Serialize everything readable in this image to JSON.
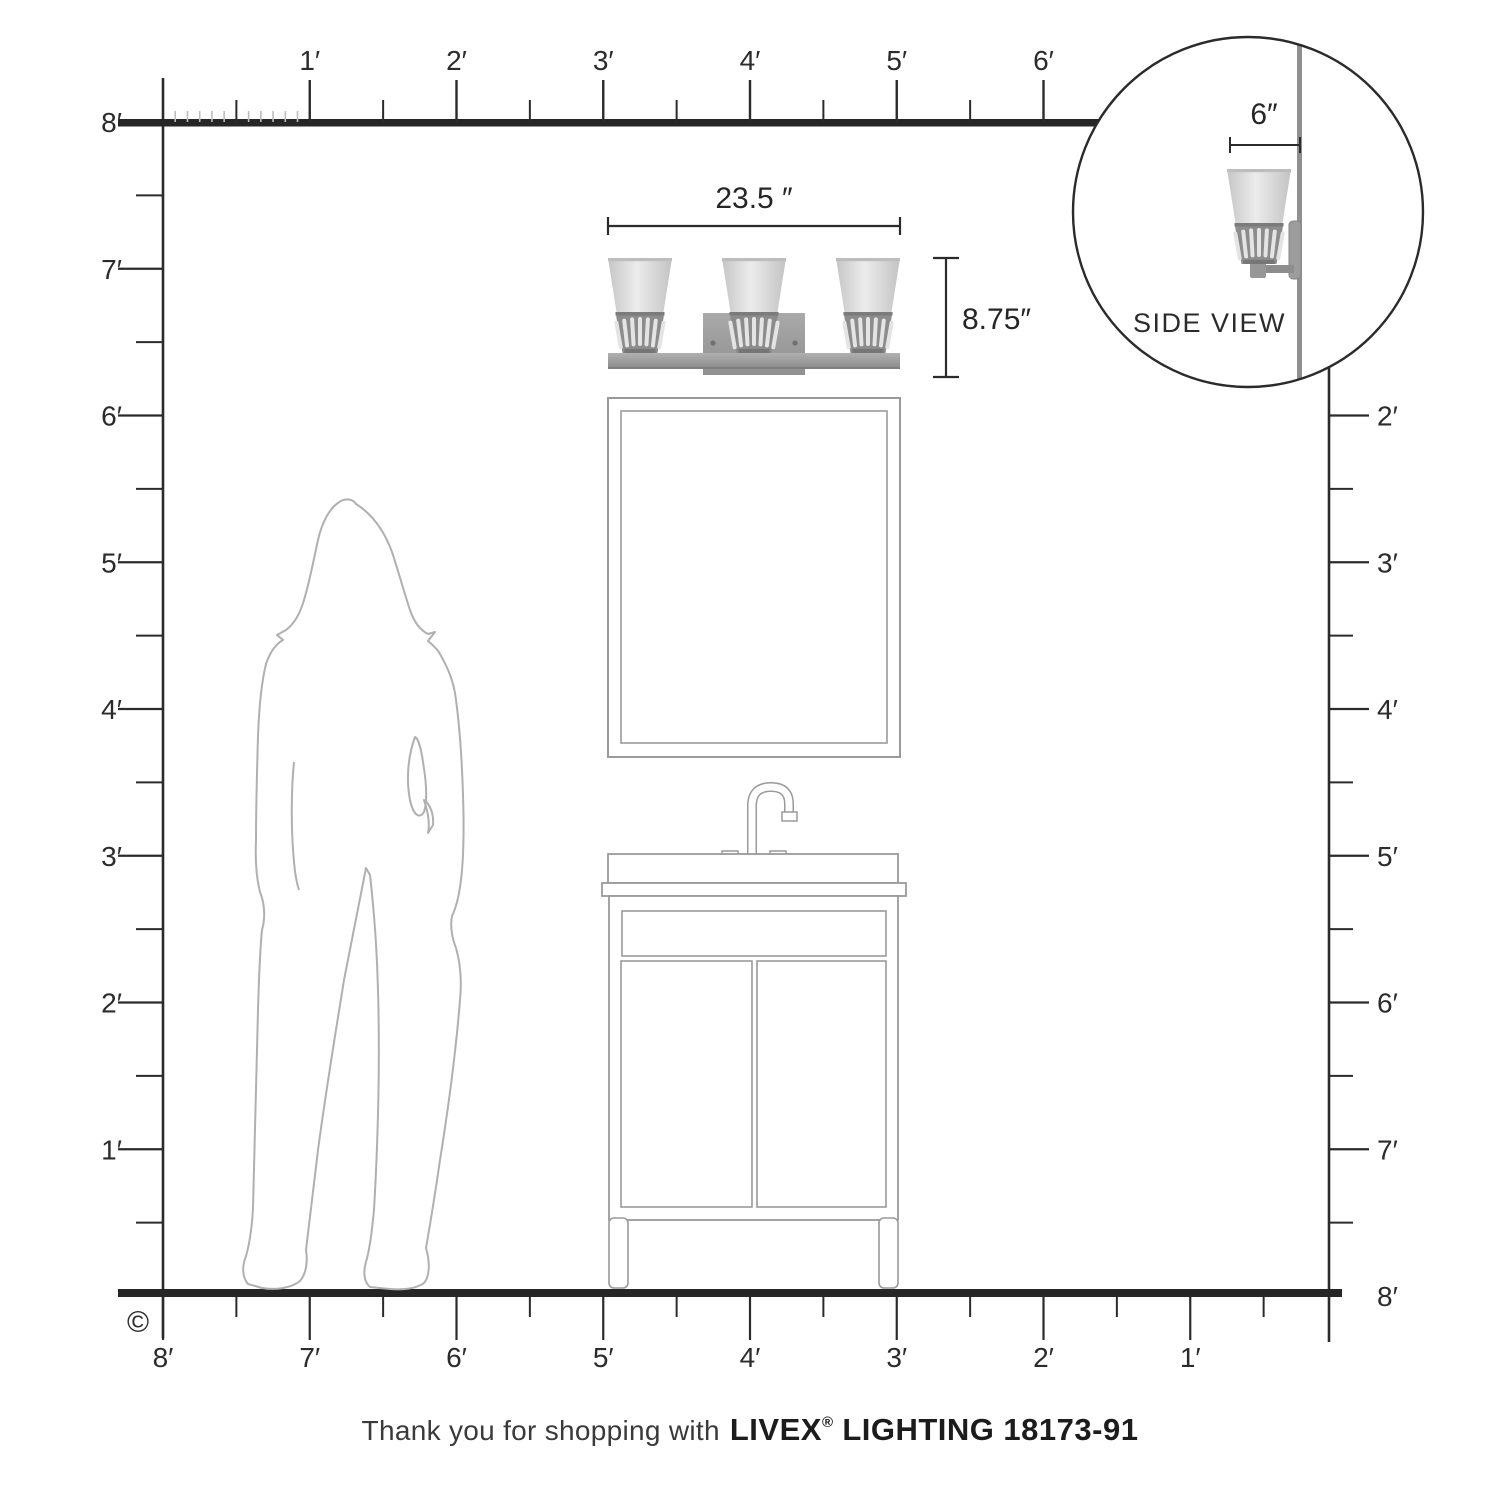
{
  "page": {
    "type": "product-dimension-diagram",
    "product": {
      "brand": "LIVEX",
      "registered_mark": "®",
      "line": "LIGHTING",
      "model": "18173-91"
    },
    "footer": {
      "thanks": "Thank you for shopping with"
    },
    "copyright_symbol": "©",
    "annotations": {
      "fixture_width": "23.5 ″",
      "fixture_height": "8.75″",
      "side_depth": "6″",
      "side_view_label": "SIDE VIEW"
    },
    "rulers": {
      "unit": "feet",
      "max_feet": 8,
      "top_labels": [
        "1′",
        "2′",
        "3′",
        "4′",
        "5′",
        "6′"
      ],
      "left_labels": [
        "8′",
        "7′",
        "6′",
        "5′",
        "4′",
        "3′",
        "2′",
        "1′"
      ],
      "right_labels": [
        "2′",
        "3′",
        "4′",
        "5′",
        "6′",
        "7′",
        "8′"
      ],
      "bottom_labels": [
        "8′",
        "7′",
        "6′",
        "5′",
        "4′",
        "3′",
        "2′",
        "1′"
      ]
    },
    "colors": {
      "line_dark": "#2b2b2b",
      "furniture_outline": "#9a9a9a",
      "silhouette_outline": "#b0b0b0",
      "metal_gray": "#939393",
      "glass_gray": "#d8d8d8",
      "band_gray": "#8c8c8c",
      "slot_light": "#e4e4e4"
    }
  }
}
